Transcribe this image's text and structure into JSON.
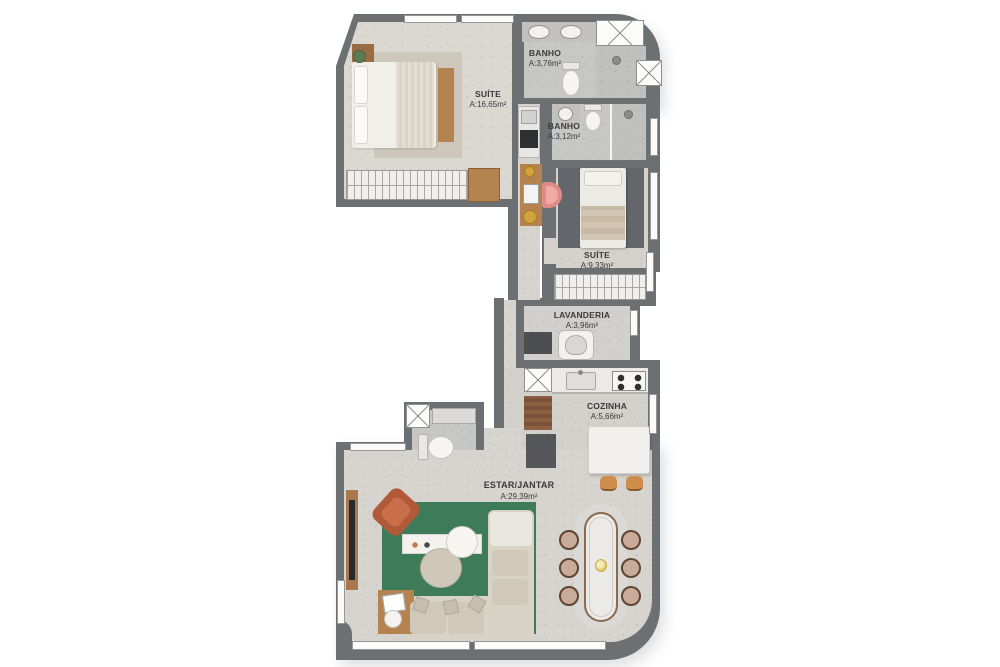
{
  "plan": {
    "rooms": [
      {
        "name": "BANHO",
        "area": "A:3,76m²"
      },
      {
        "name": "SUÍTE",
        "area": "A:16,65m²"
      },
      {
        "name": "BANHO",
        "area": "A:3,12m²"
      },
      {
        "name": "SUÍTE",
        "area": "A:9,33m²"
      },
      {
        "name": "LAVANDERIA",
        "area": "A:3,96m²"
      },
      {
        "name": "COZINHA",
        "area": "A:5,66m²"
      },
      {
        "name": "ESTAR/JANTAR",
        "area": "A:29,39m²"
      }
    ],
    "colors": {
      "wall": "#6d7072",
      "floor_light": "#dbd8d2",
      "floor_bath": "#c7c7c5",
      "rug_green": "#3e7b58",
      "rug_dark": "#63666a",
      "wood": "#b5834f",
      "terracotta": "#b05a3a",
      "chair_pink": "#e08b85",
      "stool_orange": "#cf8d4c",
      "brass": "#d2a33c",
      "label_text": "#3a3a3a"
    }
  }
}
